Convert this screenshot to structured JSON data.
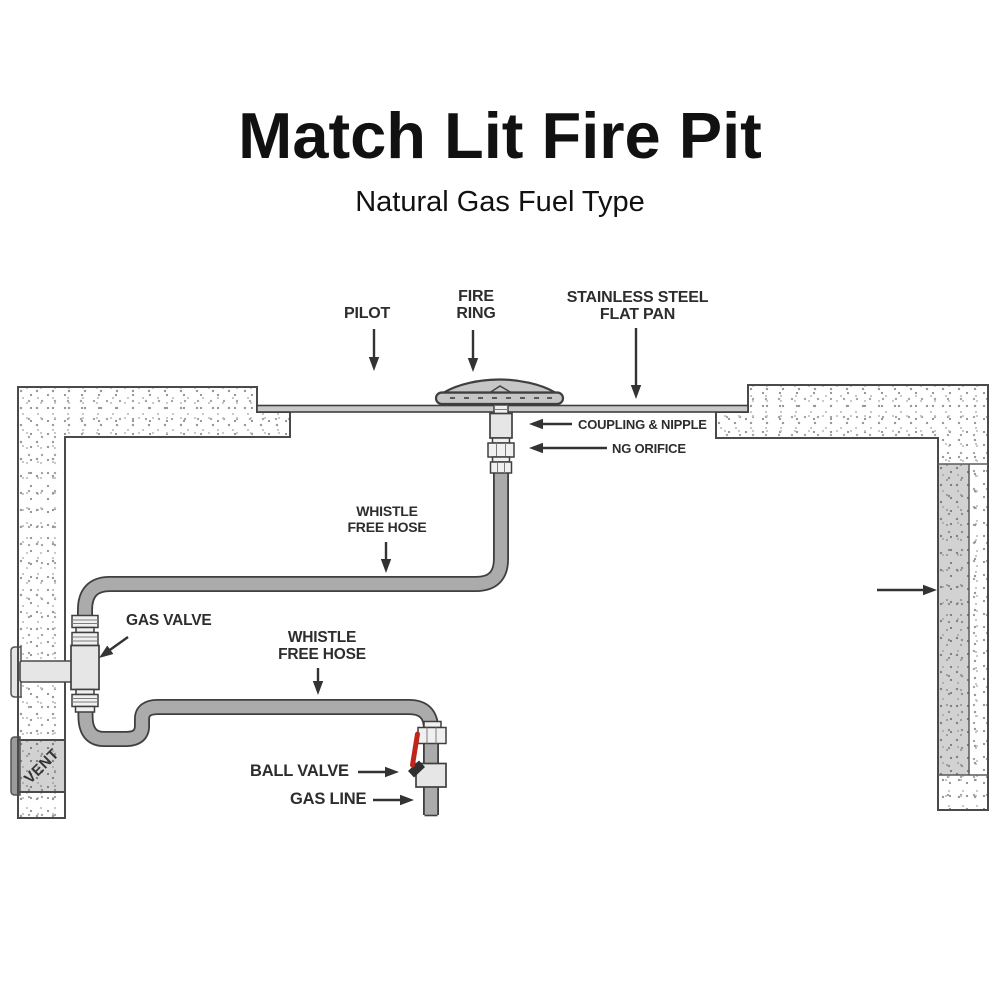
{
  "header": {
    "title": "Match Lit Fire Pit",
    "subtitle": "Natural Gas Fuel Type"
  },
  "labels": {
    "pilot": "PILOT",
    "fire_ring": {
      "l1": "FIRE",
      "l2": "RING"
    },
    "flat_pan": {
      "l1": "STAINLESS STEEL",
      "l2": "FLAT PAN"
    },
    "coupling_nipple": "COUPLING & NIPPLE",
    "ng_orifice": "NG ORIFICE",
    "whistle_free_hose_top": {
      "l1": "WHISTLE",
      "l2": "FREE HOSE"
    },
    "whistle_free_hose_bottom": {
      "l1": "WHISTLE",
      "l2": "FREE HOSE"
    },
    "gas_valve": "GAS VALVE",
    "ball_valve": "BALL VALVE",
    "gas_line": "GAS LINE",
    "vent": "VENT"
  },
  "colors": {
    "outline": "#3f3f3f",
    "wall_line": "#4a4a4a",
    "tube": "#ababab",
    "fitting": "#f0f0f0",
    "fitting_mid": "#e6e6e6",
    "ring_gray": "#c6c6c6",
    "pan_gray": "#c9c9c9",
    "tab_light": "#e6e6e6",
    "tab_dark": "#9b9b9b",
    "handle_red": "#c0251c",
    "text": "#2d2d2d",
    "arrow": "#333333"
  }
}
